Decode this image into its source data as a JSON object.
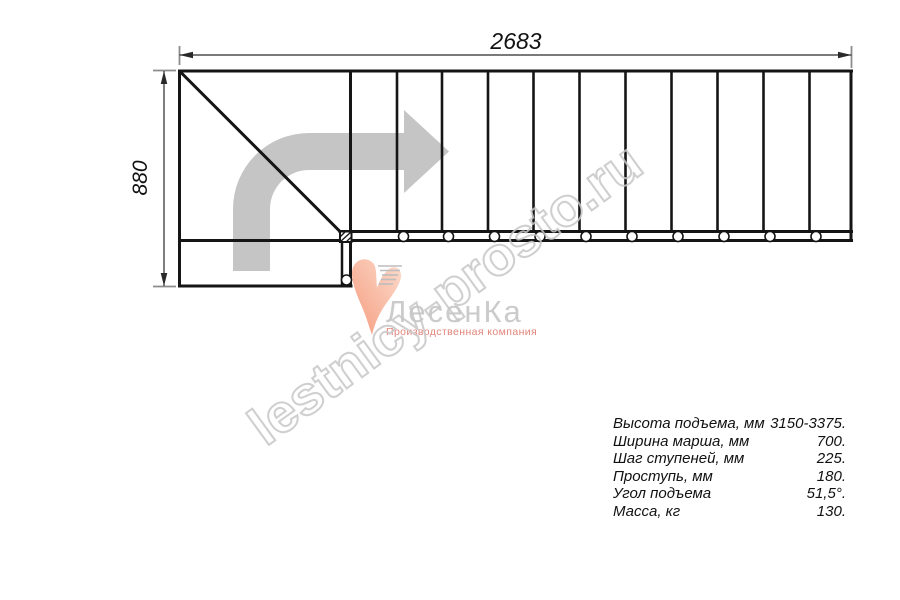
{
  "dimensions": {
    "length_mm": "2683",
    "width_mm": "880"
  },
  "watermark": {
    "text": "lestnicy-prosto.ru",
    "color": "#c7c7c7"
  },
  "logo": {
    "name": "ЛесенКа",
    "tagline": "Производственная компания",
    "heart_icon": "heart-swoosh-icon",
    "colors": {
      "heart": "#f7a585",
      "name_text": "#cbcbcb",
      "tagline_text": "#e2847a"
    }
  },
  "specs": {
    "rows": [
      {
        "label": "Высота подъема, мм",
        "value": "3150-3375."
      },
      {
        "label": "Ширина марша, мм",
        "value": "700."
      },
      {
        "label": "Шаг ступеней, мм",
        "value": "225."
      },
      {
        "label": "Проступь, мм",
        "value": "180."
      },
      {
        "label": "Угол подъема",
        "value": "51,5°."
      },
      {
        "label": "Масса, кг",
        "value": "130."
      }
    ]
  },
  "drawing": {
    "direction_arrow_icon": "curved-right-arrow",
    "line_color": "#151515",
    "arrow_color": "#c5c5c5"
  }
}
